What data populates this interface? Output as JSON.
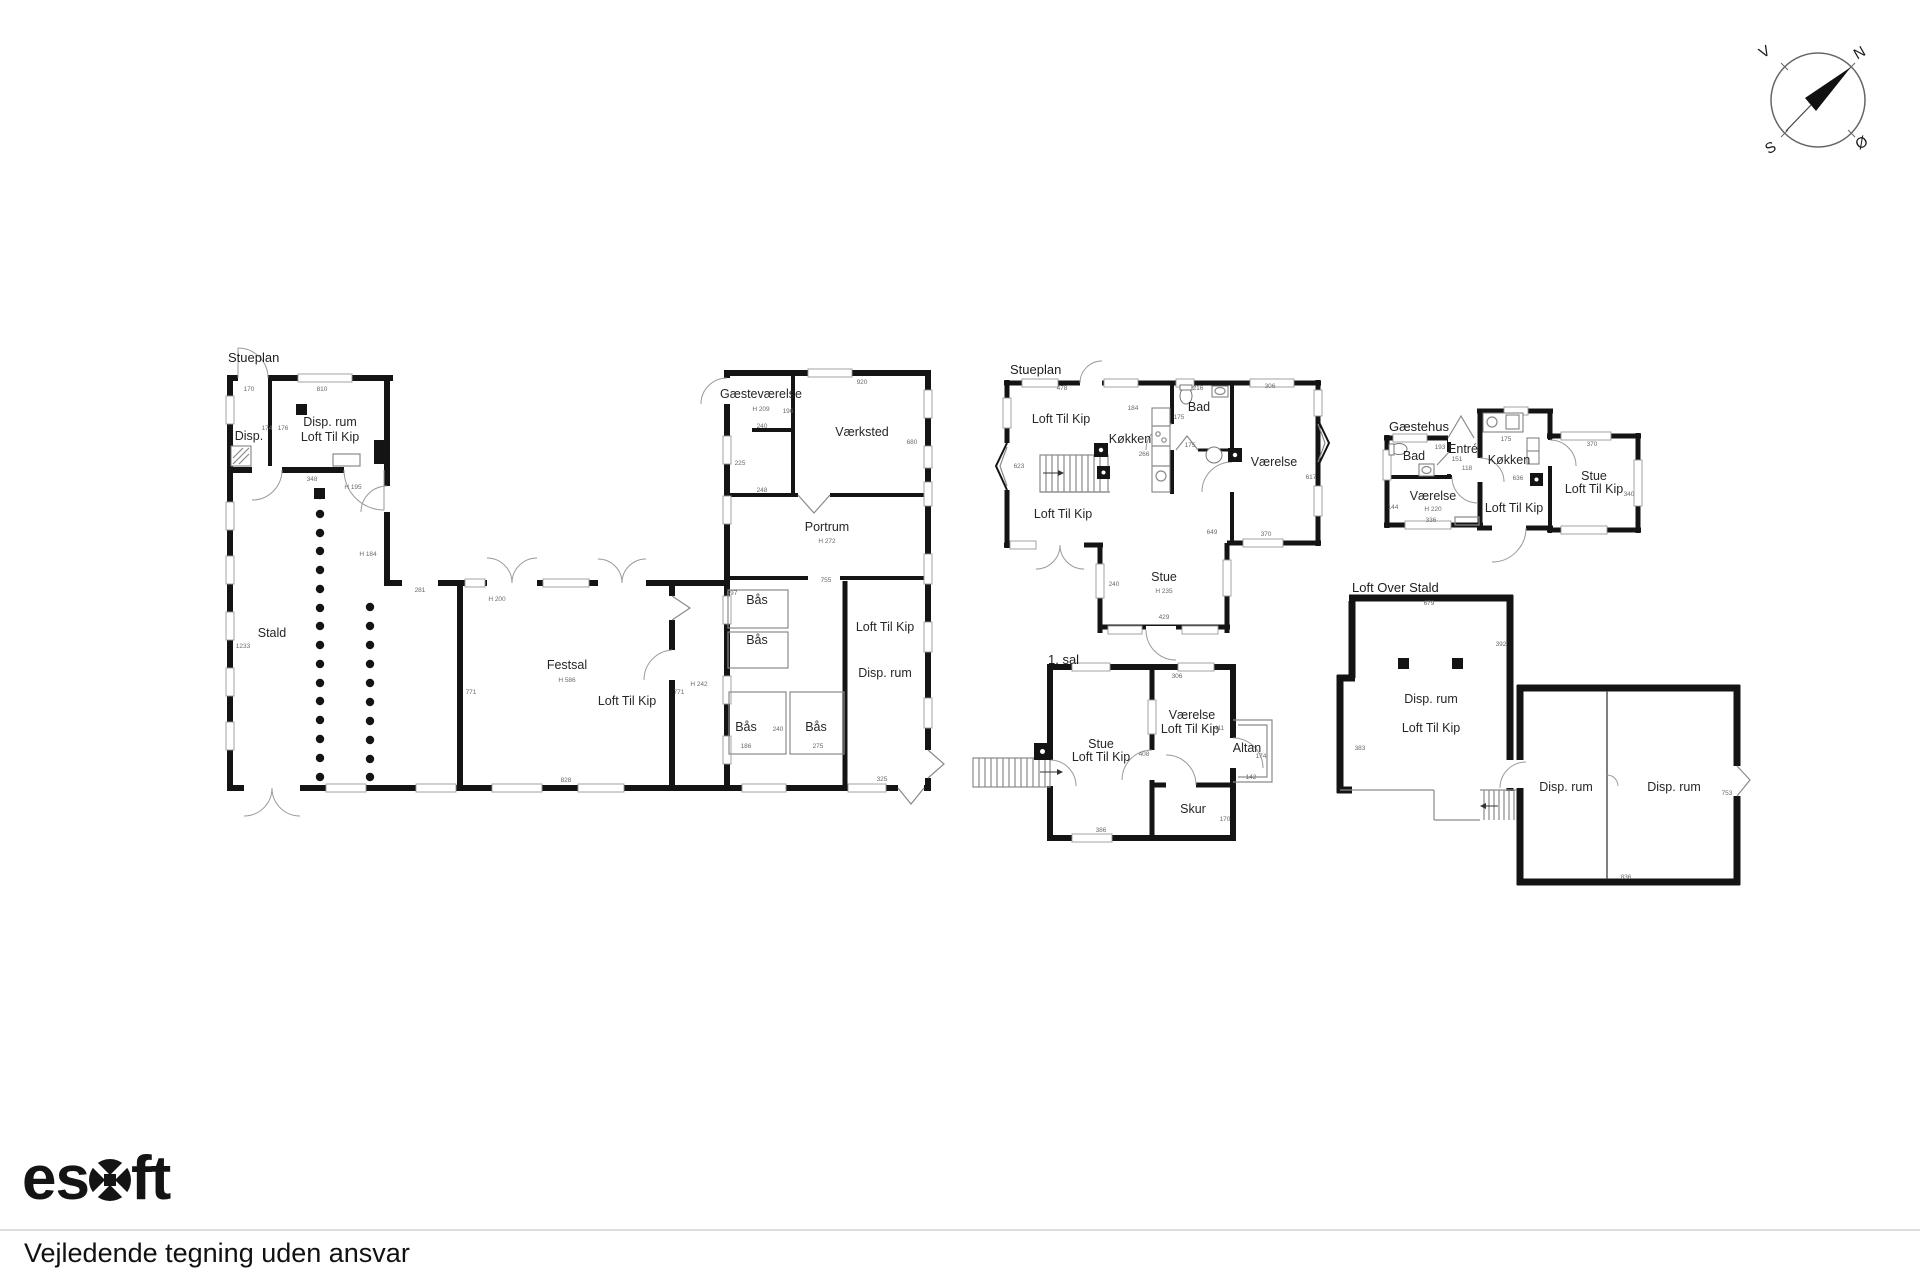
{
  "compass": {
    "north": "N",
    "south": "S",
    "east": "Ø",
    "west": "V"
  },
  "footer": {
    "brand": "esoft",
    "brand_es": "es",
    "brand_ft": "ft",
    "disclaimer": "Vejledende tegning uden ansvar"
  },
  "plans": [
    {
      "title": "Stueplan",
      "rooms": [
        "Disp.",
        "Disp. rum",
        "Loft Til Kip",
        "Stald",
        "Festsal",
        "Loft Til Kip",
        "Gæsteværelse",
        "Værksted",
        "Portrum",
        "Bås",
        "Bås",
        "Bås",
        "Bås",
        "Loft Til Kip",
        "Disp. rum"
      ],
      "meas": [
        "170",
        "810",
        "174",
        "176",
        "348",
        "H 195",
        "H 184",
        "1233",
        "281",
        "H 200",
        "H 586",
        "771",
        "771",
        "H 242",
        "828",
        "697",
        "920",
        "H 209",
        "196",
        "240",
        "225",
        "248",
        "680",
        "H 272",
        "755",
        "240",
        "186",
        "275",
        "325"
      ]
    },
    {
      "title": "Stueplan",
      "rooms": [
        "Loft Til Kip",
        "Køkken",
        "Bad",
        "Værelse",
        "Loft Til Kip",
        "Stue"
      ],
      "meas": [
        "478",
        "184",
        "216",
        "175",
        "175",
        "266",
        "306",
        "623",
        "617",
        "H 235",
        "649",
        "370",
        "240",
        "429"
      ]
    },
    {
      "title": "Gæstehus",
      "rooms": [
        "Bad",
        "Entré",
        "Køkken",
        "Værelse",
        "Loft Til Kip",
        "Stue",
        "Loft Til Kip"
      ],
      "meas": [
        "193",
        "151",
        "118",
        "175",
        "370",
        "636",
        "H 220",
        "144",
        "336",
        "340"
      ]
    },
    {
      "title": "1. sal",
      "rooms": [
        "Stue",
        "Loft Til Kip",
        "Værelse",
        "Loft Til Kip",
        "Altan",
        "Skur"
      ],
      "meas": [
        "306",
        "411",
        "408",
        "174",
        "142",
        "170",
        "386"
      ]
    },
    {
      "title": "Loft Over Stald",
      "rooms": [
        "Disp. rum",
        "Loft Til Kip",
        "Disp. rum",
        "Disp. rum"
      ],
      "meas": [
        "679",
        "392",
        "383",
        "836",
        "753"
      ]
    }
  ]
}
